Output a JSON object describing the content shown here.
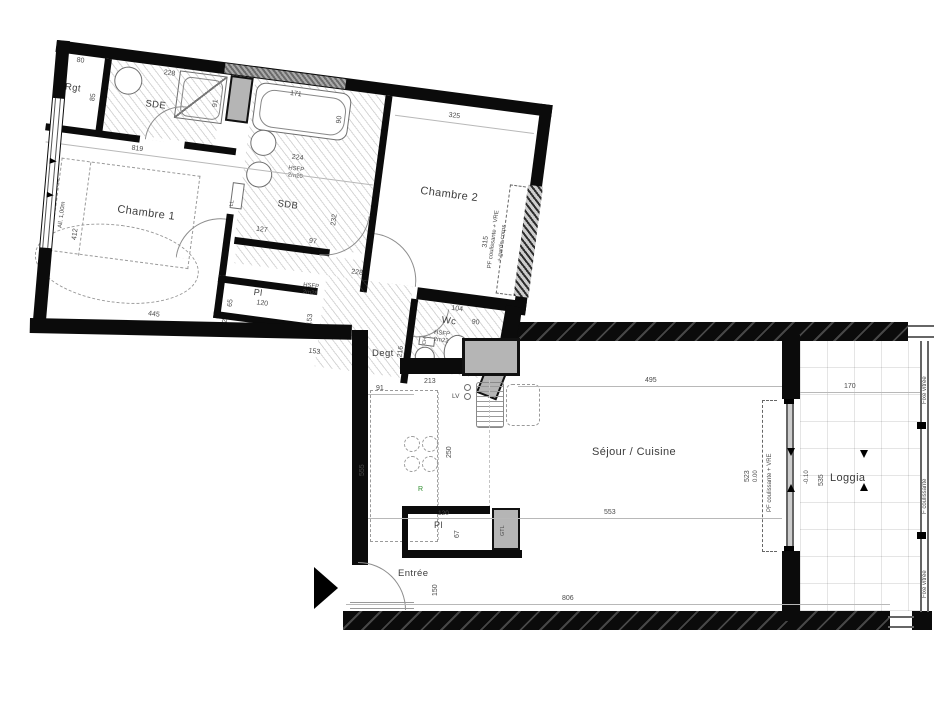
{
  "colors": {
    "wall": "#0b0b0b",
    "duct": "#b5b5b5",
    "fridge_letter": "#2f8f2f"
  },
  "rooms": {
    "rgt": "Rgt",
    "sde": "SDE",
    "sdb": "SDB",
    "chambre1": "Chambre 1",
    "chambre2": "Chambre 2",
    "wc": "Wc",
    "degt": "Degt",
    "pl_hall": "Pl",
    "pl_entree": "Pl",
    "sejour": "Séjour / Cuisine",
    "entree": "Entrée",
    "loggia": "Loggia"
  },
  "ceiling": {
    "sdb": "HSFP\n2m20",
    "hall": "HSFP\n2m28",
    "wc": "HSFP\n2m22"
  },
  "appliances": {
    "washing_machine": "LL",
    "dishwasher": "LV",
    "fridge": "R",
    "gtl": "GTL",
    "water_heater": "CH"
  },
  "windows": {
    "ch1_line1": "F coulissante + VRE",
    "ch1_line2": "All. 1,00m",
    "ch2_line1": "PF coulissante + VRE",
    "ch2_line2": "+ garde-corps",
    "sejour_door": "PF coulissante + VRE",
    "loggia_top": "Fixe vitrée",
    "loggia_mid": "F coulissante",
    "loggia_bot": "Fixe vitrée"
  },
  "levels": {
    "interior": "0.00",
    "loggia": "-0.10"
  },
  "dims": {
    "rgt_w": "80",
    "rgt_d": "85",
    "sde_w": "228",
    "shower": "91",
    "width_819": "819",
    "tub_l": "171",
    "tub_w": "90",
    "sdb_w": "224",
    "sdb_h": "232",
    "sdb_127": "127",
    "hall_97": "97",
    "ch2_w": "325",
    "ch2_h": "315",
    "ch2_228": "228",
    "ch1_w": "445",
    "ch1_h": "412",
    "ch1_112": "112",
    "pl_153": "153",
    "hall_153": "153",
    "pl_w": "120",
    "pl_d": "65",
    "wc_h": "216",
    "wc_w": "104",
    "wc_90": "90",
    "wc_79": "79",
    "wc_100": "100",
    "k_213": "213",
    "degt_91": "91",
    "k_250": "250",
    "pl2_w": "120",
    "pl2_d": "67",
    "entree_150": "150",
    "total_806": "806",
    "left_555": "555",
    "sejour_495": "495",
    "sejour_553": "553",
    "sejour_523": "523",
    "loggia_170": "170",
    "loggia_535": "535"
  }
}
